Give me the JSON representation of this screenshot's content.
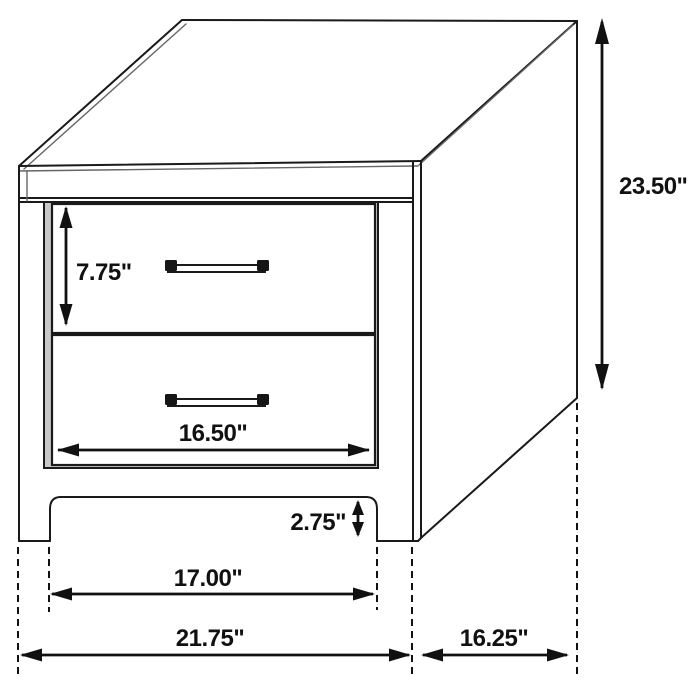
{
  "diagram": {
    "type": "furniture-dimension-diagram",
    "item": "two-drawer nightstand isometric line drawing",
    "unit": "inches",
    "dimensions": {
      "overall_height": "23.50\"",
      "drawer_height": "7.75\"",
      "drawer_width": "16.50\"",
      "leg_height": "2.75\"",
      "leg_span": "17.00\"",
      "overall_width": "21.75\"",
      "depth": "16.25\""
    },
    "colors": {
      "line": "#1a1a1a",
      "dimension": "#111111",
      "background": "#ffffff",
      "drawer_gap": "#c8c8c8"
    }
  }
}
